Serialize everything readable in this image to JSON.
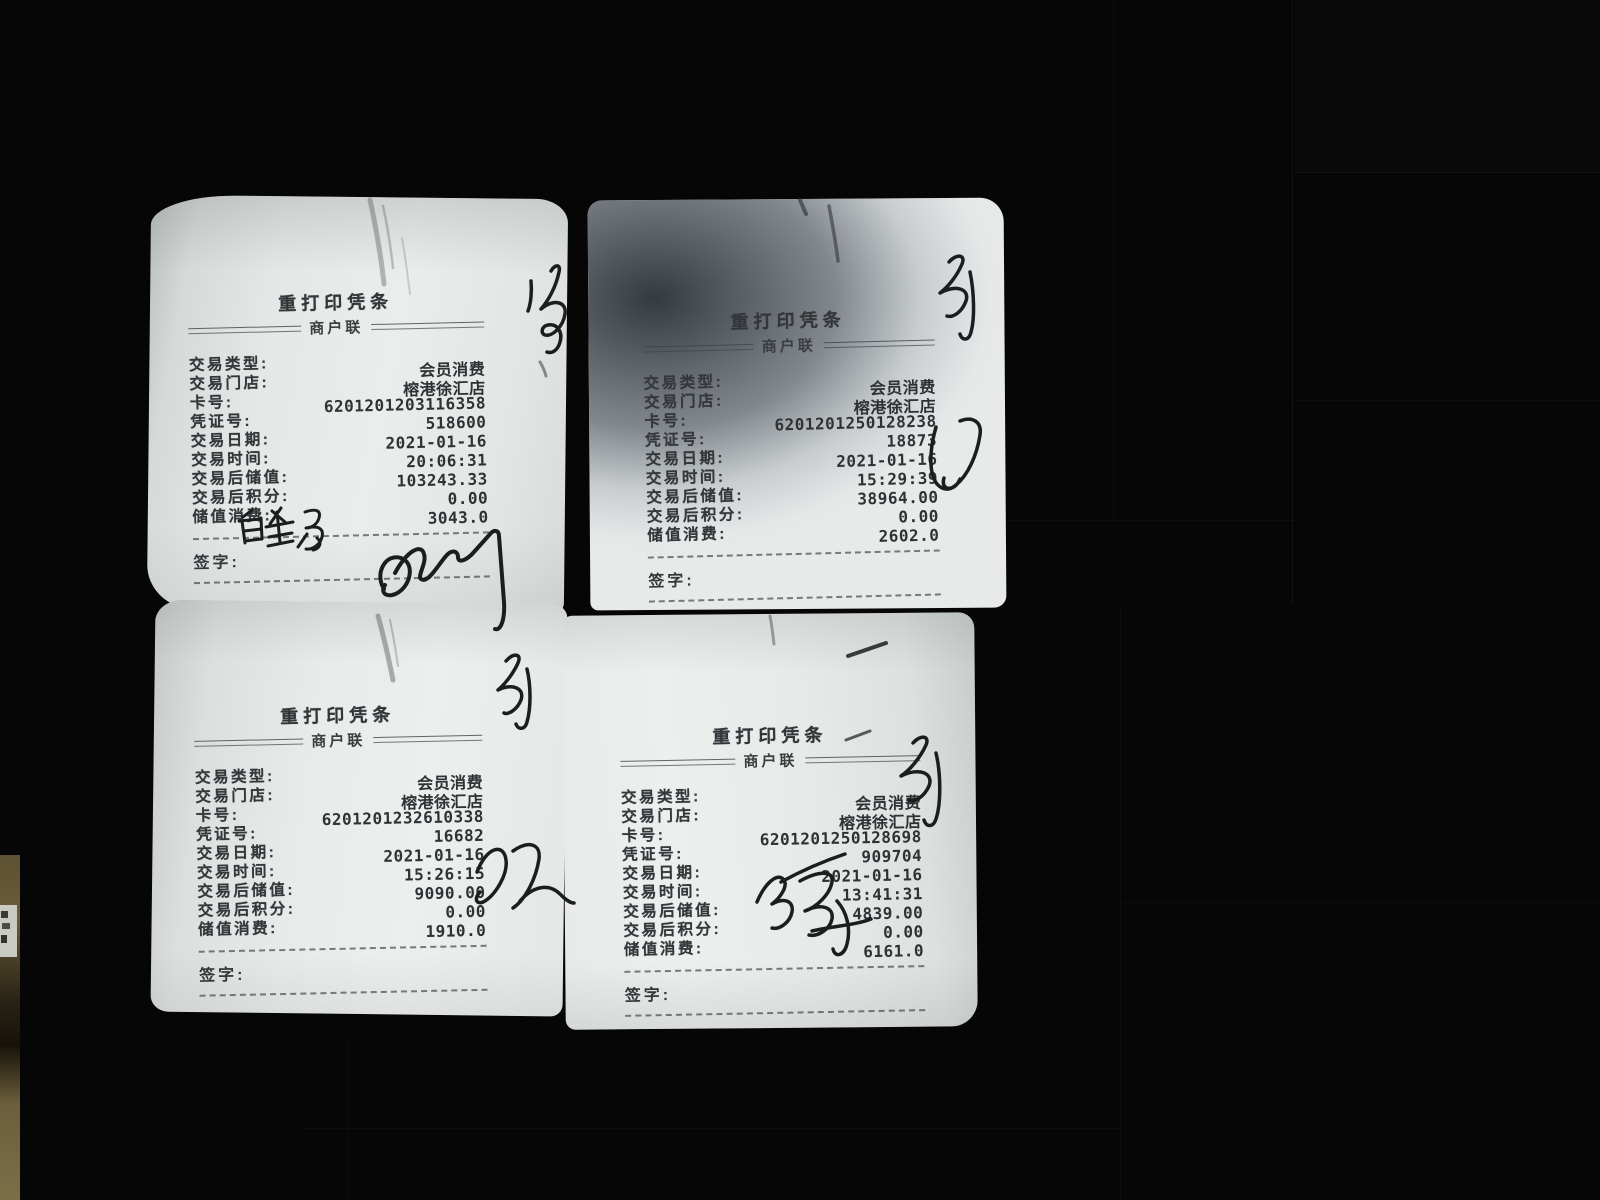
{
  "title": "重打印凭条",
  "subtitle": "商户联",
  "labels": {
    "type": "交易类型:",
    "store": "交易门店:",
    "card": "卡号:",
    "voucher": "凭证号:",
    "date": "交易日期:",
    "time": "交易时间:",
    "balance": "交易后储值:",
    "points": "交易后积分:",
    "consume": "储值消费:",
    "sign": "签字:"
  },
  "receipts": [
    {
      "position": "top-left",
      "type": "会员消费",
      "store": "榕港徐汇店",
      "card": "6201201203116358",
      "voucher": "518600",
      "date": "2021-01-16",
      "time": "20:06:31",
      "balance": "103243.33",
      "points": "0.00",
      "consume": "3043.0"
    },
    {
      "position": "top-right",
      "type": "会员消费",
      "store": "榕港徐汇店",
      "card": "6201201250128238",
      "voucher": "18873",
      "date": "2021-01-16",
      "time": "15:29:39",
      "balance": "38964.00",
      "points": "0.00",
      "consume": "2602.0"
    },
    {
      "position": "bottom-left",
      "type": "会员消费",
      "store": "榕港徐汇店",
      "card": "6201201232610338",
      "voucher": "16682",
      "date": "2021-01-16",
      "time": "15:26:15",
      "balance": "9090.00",
      "points": "0.00",
      "consume": "1910.0"
    },
    {
      "position": "bottom-right",
      "type": "会员消费",
      "store": "榕港徐汇店",
      "card": "6201201250128698",
      "voucher": "909704",
      "date": "2021-01-16",
      "time": "13:41:31",
      "balance": "4839.00",
      "points": "0.00",
      "consume": "6161.0"
    }
  ],
  "marks": {
    "ink_color": "#1c1d1f",
    "paper_color": "#e9ecEB",
    "background_color": "#060606"
  }
}
